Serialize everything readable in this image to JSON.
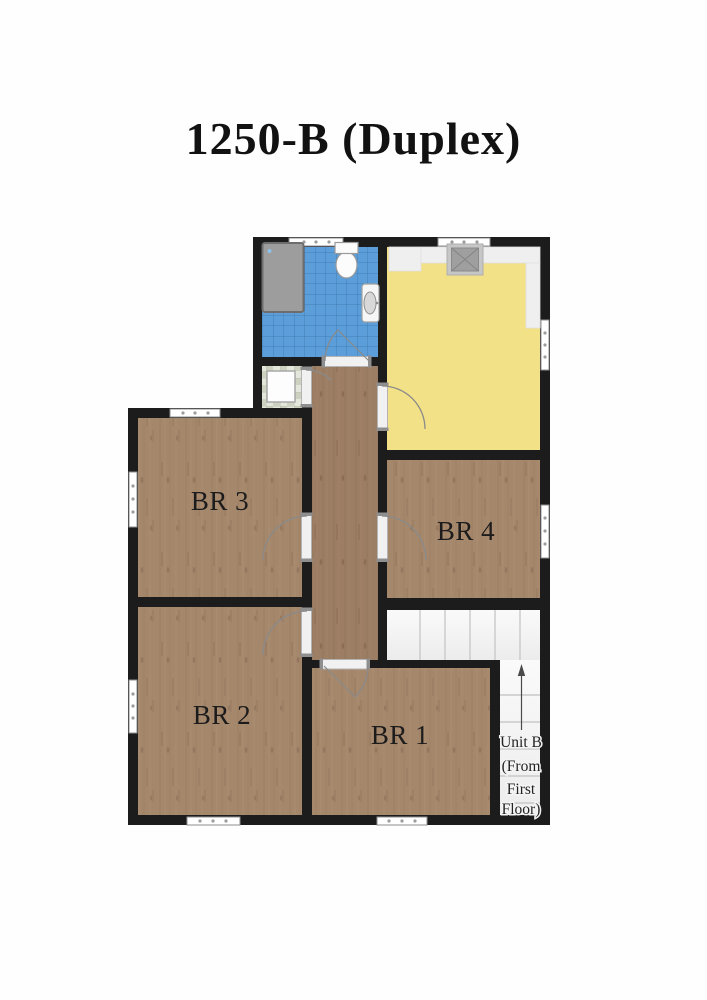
{
  "title": "1250-B (Duplex)",
  "rooms": {
    "br1": {
      "label": "BR 1"
    },
    "br2": {
      "label": "BR 2"
    },
    "br3": {
      "label": "BR 3"
    },
    "br4": {
      "label": "BR 4"
    }
  },
  "stairs": {
    "direction": "up",
    "note_lines": [
      "Unit B",
      "(From",
      "First",
      "Floor)"
    ]
  },
  "colors": {
    "wall": "#1c1c1c",
    "wood": "#a5876c",
    "wood_dark": "#9c7e64",
    "tile_blue": "#5b9ed9",
    "tile_grout": "#437fb4",
    "kitchen_yellow": "#f3e187",
    "stair_tread": "#f4f4f4",
    "label_text": "#1c1c1c"
  }
}
